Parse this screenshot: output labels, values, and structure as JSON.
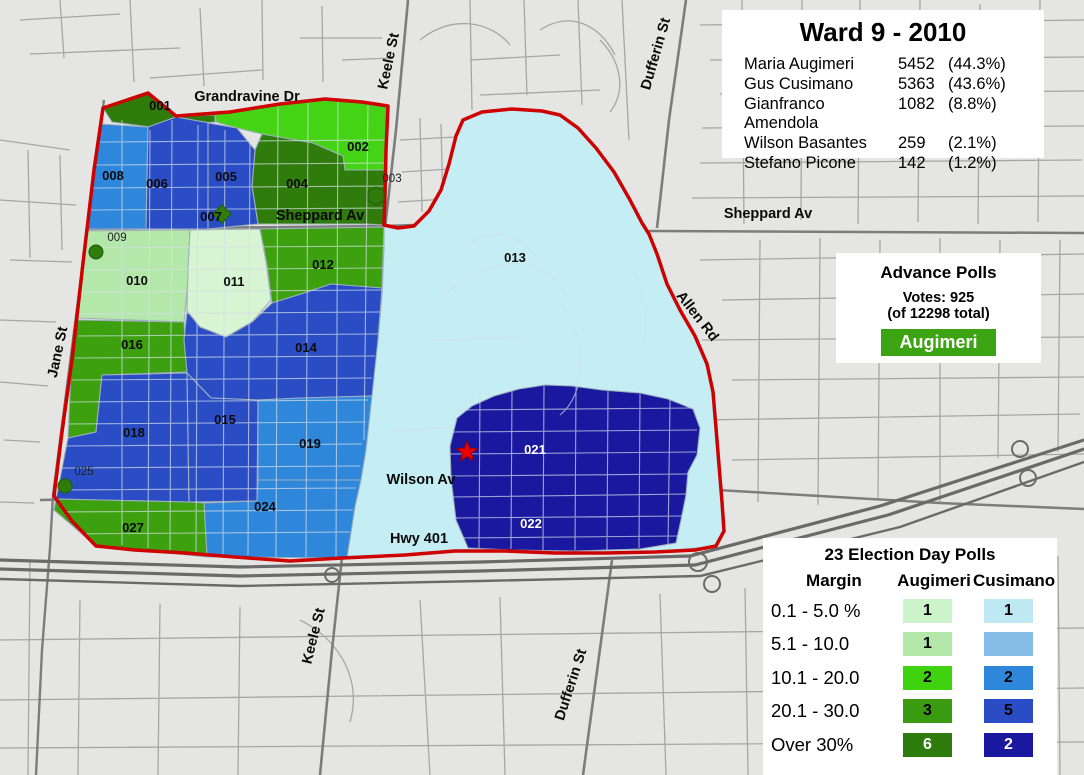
{
  "colors": {
    "map_bg": "#E5E5E3",
    "street_minor": "#A6A6A6",
    "street_major": "#7D7D7D",
    "highway": "#6A6A6A",
    "region_border": "#9FAFBE",
    "ward_boundary": "#CE0000",
    "star_red": "#EE0000",
    "green_pale": "#D7F4D3",
    "green_light": "#B4E8AB",
    "green_bright": "#45D315",
    "green_medium": "#3CA00F",
    "green_dark": "#2F7C0C",
    "blue_pale": "#C4EDF4",
    "blue_light": "#84BCE6",
    "blue_medium": "#2F87DB",
    "blue_royal": "#2A4DC5",
    "blue_navy": "#1B18A0",
    "overlay_street": "#D6DEE6"
  },
  "title_box": {
    "title": "Ward 9 - 2010",
    "results": [
      {
        "name": "Maria Augimeri",
        "votes": "5452",
        "pct": "(44.3%)"
      },
      {
        "name": "Gus Cusimano",
        "votes": "5363",
        "pct": "(43.6%)"
      },
      {
        "name": "Gianfranco Amendola",
        "votes": "1082",
        "pct": "(8.8%)"
      },
      {
        "name": "Wilson Basantes",
        "votes": "259",
        "pct": "(2.1%)"
      },
      {
        "name": "Stefano Picone",
        "votes": "142",
        "pct": "(1.2%)"
      }
    ]
  },
  "advance_box": {
    "title": "Advance Polls",
    "votes_line": "Votes: 925",
    "total_line": "(of 12298 total)",
    "winner_label": "Augimeri",
    "winner_color": "#3CA313"
  },
  "legend": {
    "title": "23 Election Day Polls",
    "margin_header": "Margin",
    "col_a_header": "Augimeri",
    "col_b_header": "Cusimano",
    "rows": [
      {
        "margin": "0.1 - 5.0 %",
        "a": "1",
        "c": "1",
        "a_color": "#CDF3CB",
        "c_color": "#BFE9F2"
      },
      {
        "margin": "5.1 - 10.0",
        "a": "1",
        "c": "",
        "a_color": "#B4E8AB",
        "c_color": "#84BCE6"
      },
      {
        "margin": "10.1 - 20.0",
        "a": "2",
        "c": "2",
        "a_color": "#3ED20F",
        "c_color": "#2F87DB"
      },
      {
        "margin": "20.1 - 30.0",
        "a": "3",
        "c": "5",
        "a_color": "#3A9B10",
        "c_color": "#2A4DC5"
      },
      {
        "margin": "Over 30%",
        "a": "6",
        "c": "2",
        "a_color": "#2E7C0B",
        "c_color": "#1B18A0"
      }
    ]
  },
  "map": {
    "street_labels": {
      "grandravine": "Grandravine Dr",
      "keele": "Keele St",
      "dufferin": "Dufferin St",
      "jane": "Jane St",
      "sheppard": "Sheppard Av",
      "allen": "Allen Rd",
      "wilson": "Wilson Av",
      "hwy401": "Hwy 401"
    },
    "polls": {
      "p001": "001",
      "p002": "002",
      "p003": "003",
      "p004": "004",
      "p005": "005",
      "p006": "006",
      "p007": "007",
      "p008": "008",
      "p009": "009",
      "p010": "010",
      "p011": "011",
      "p012": "012",
      "p013": "013",
      "p014": "014",
      "p015": "015",
      "p016": "016",
      "p018": "018",
      "p019": "019",
      "p021": "021",
      "p022": "022",
      "p024": "024",
      "p025": "025",
      "p027": "027"
    }
  }
}
